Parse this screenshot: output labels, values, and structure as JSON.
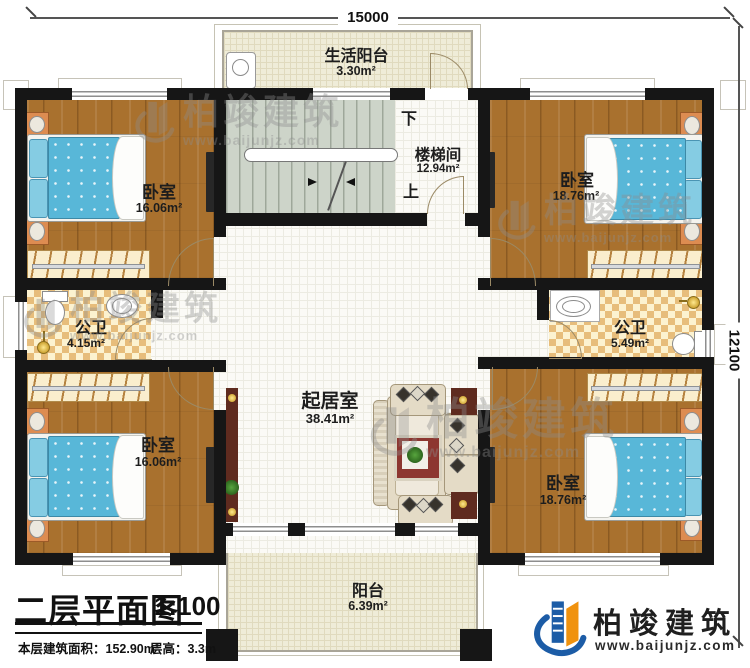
{
  "dimensions": {
    "top": "15000",
    "right": "12100"
  },
  "rooms": {
    "life_balcony": {
      "name": "生活阳台",
      "area": "3.30m²"
    },
    "stairwell": {
      "name": "楼梯间",
      "area": "12.94m²",
      "down": "下",
      "up": "上"
    },
    "bedroom_top_left": {
      "name": "卧室",
      "area": "16.06m²"
    },
    "bedroom_top_right": {
      "name": "卧室",
      "area": "18.76m²"
    },
    "bedroom_bottom_left": {
      "name": "卧室",
      "area": "16.06m²"
    },
    "bedroom_bottom_right": {
      "name": "卧室",
      "area": "18.76m²"
    },
    "bathroom_left": {
      "name": "公卫",
      "area": "4.15m²"
    },
    "bathroom_right": {
      "name": "公卫",
      "area": "5.49m²"
    },
    "living_room": {
      "name": "起居室",
      "area": "38.41m²"
    },
    "balcony": {
      "name": "阳台",
      "area": "6.39m²"
    }
  },
  "title_block": {
    "title": "二层平面图",
    "scale": "1:100",
    "floor_area_label": "本层建筑面积：152.90m²",
    "floor_height_label": "层高：3.3m"
  },
  "logo": {
    "company": "柏竣建筑",
    "website": "www.baijunjz.com"
  },
  "watermark": {
    "brand": "柏竣建筑",
    "website": "www.baijunjz.com"
  },
  "colors": {
    "accent_blue": "#1c5ca6",
    "accent_orange": "#f0920e",
    "wall": "#161616",
    "wood": "#a9712e",
    "mattress": "#58b7d8"
  }
}
